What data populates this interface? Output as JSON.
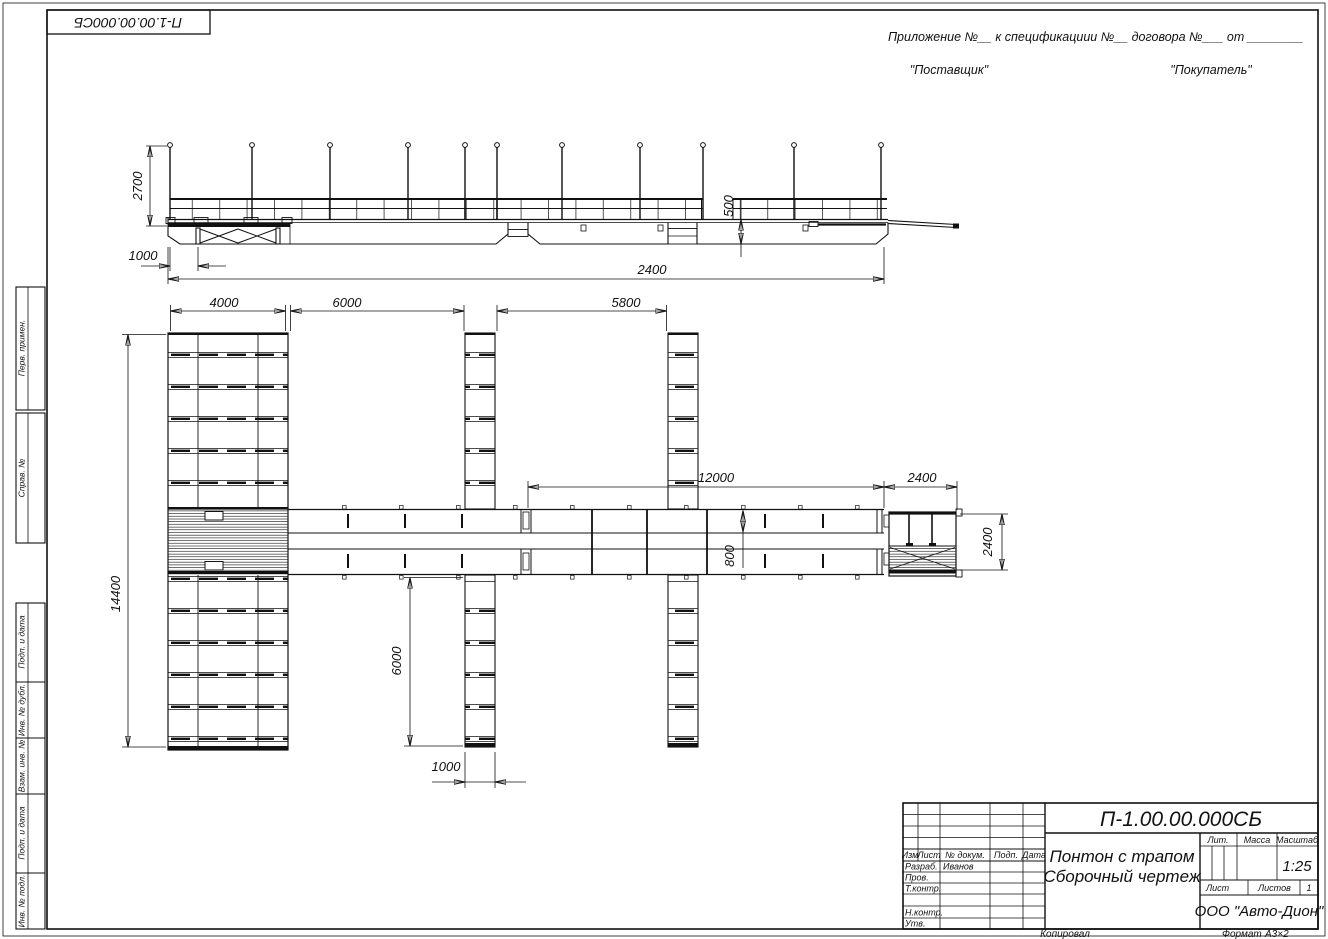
{
  "corner_stamp": {
    "doc_number_rotated": "П-1.00.00.000СБ"
  },
  "header_note": {
    "line": "Приложение №__      к спецификациии №__    договора №___   от ________",
    "supplier": "\"Поставщик\"",
    "buyer": "\"Покупатель\""
  },
  "frame_labels": {
    "perv_primen": "Перв. примен.",
    "sprav_no": "Справ. №",
    "podp_data_1": "Подп. и дата",
    "inv_dubl": "Инв. № дубл.",
    "vzam_inv": "Взам. инв. №",
    "podp_data_2": "Подп. и дата",
    "inv_podl": "Инв. № подл."
  },
  "dims": {
    "side_post_height": "2700",
    "side_trap_offset": "1000",
    "side_overall": "2400",
    "side_freeboard": "500",
    "plan_block_width": "4000",
    "plan_bay1": "6000",
    "plan_bay2": "5800",
    "plan_walkway_len": "12000",
    "plan_terminal_width": "2400",
    "plan_terminal_height": "2400",
    "plan_lane_width": "800",
    "plan_overall_height": "14400",
    "plan_finger_length": "6000",
    "plan_finger_width": "1000"
  },
  "title_block": {
    "doc_number": "П-1.00.00.000СБ",
    "title_line1": "Понтон с трапом",
    "title_line2": "Сборочный чертеж",
    "company": "ООО \"Авто-Дион\"",
    "scale_value": "1:25",
    "sheets_value": "1",
    "col_izm": "Изм",
    "col_list": "Лист",
    "col_doc": "№ докум.",
    "col_podp": "Подп.",
    "col_data": "Дата",
    "row_razrab": "Разраб.",
    "razrab_name": "Иванов",
    "row_prov": "Пров.",
    "row_tkontr": "Т.контр.",
    "row_nkontr": "Н.контр.",
    "row_utv": "Утв.",
    "lit_label": "Лит.",
    "massa_label": "Масса",
    "masshtab_label": "Масштаб",
    "list_label": "Лист",
    "listov_label": "Листов"
  },
  "footer": {
    "copied": "Копировал",
    "format_label": "Формат",
    "format_value": "А3×2"
  }
}
